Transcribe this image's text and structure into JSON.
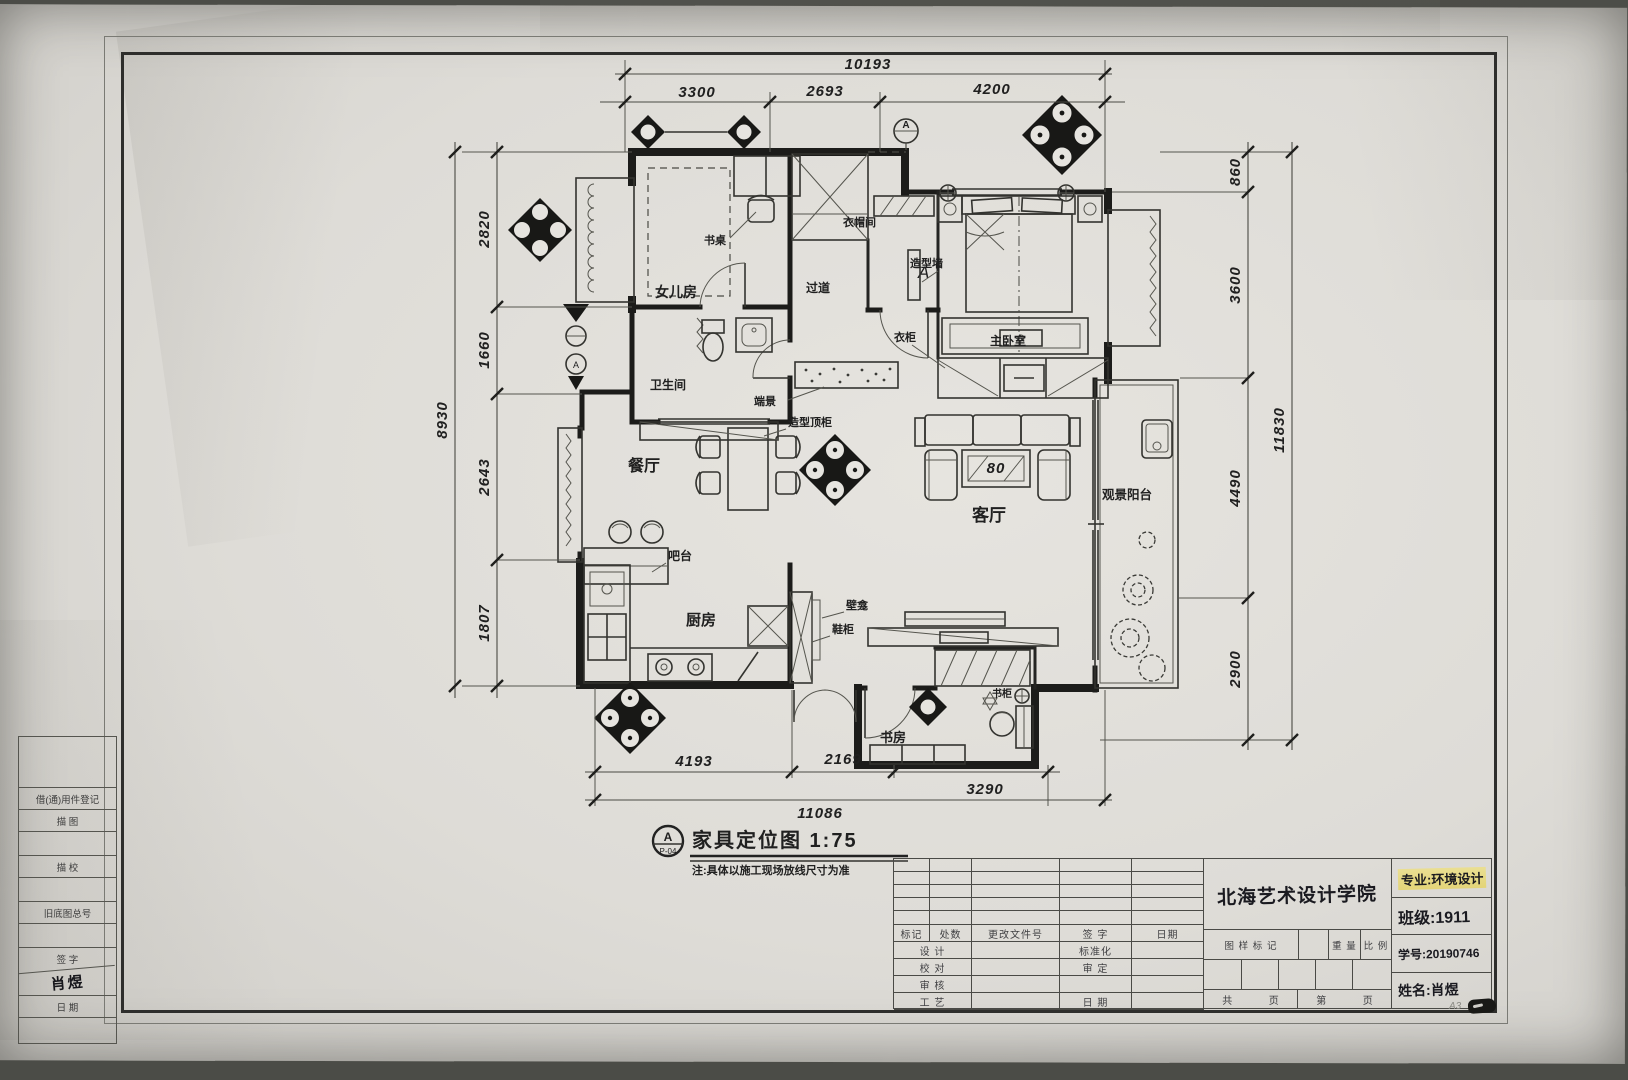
{
  "sheet": {
    "size_label": "A3"
  },
  "left_panel": {
    "rows": [
      "借(通)用件登记",
      "描  图",
      "描  校",
      "旧底图总号",
      "签  字",
      "日  期"
    ],
    "signature": "肖煜"
  },
  "callout": {
    "bubble_letter": "A",
    "bubble_code": "P-04",
    "title": "家具定位图 1:75",
    "note": "注:具体以施工现场放线尺寸为准"
  },
  "plan": {
    "rooms": {
      "girls_room": "女儿房",
      "bathroom": "卫生间",
      "corridor": "过道",
      "cloakroom": "衣帽间",
      "master_bedroom": "主卧室",
      "dining_room": "餐厅",
      "kitchen": "厨房",
      "living_room": "客厅",
      "balcony": "观景阳台",
      "study": "书房"
    },
    "labels": {
      "desk": "书桌",
      "feature_wall": "造型墙",
      "wardrobe": "衣柜",
      "end_table": "端景",
      "shaped_top_cabinet": "造型顶柜",
      "bar": "吧台",
      "wall_niche": "壁龛",
      "shoe_cabinet": "鞋柜",
      "bookcase": "书柜",
      "section_a": "A",
      "table_size": "80"
    },
    "dims": {
      "top": {
        "total": "10193",
        "segments": [
          "3300",
          "2693",
          "4200"
        ]
      },
      "left": {
        "total": "8930",
        "segments": [
          "2820",
          "1660",
          "2643",
          "1807"
        ]
      },
      "right": {
        "total": "11830",
        "segments": [
          "860",
          "3600",
          "4490",
          "2900"
        ]
      },
      "bottom": {
        "total": "11086",
        "segments": [
          "4193",
          "2169",
          "3290"
        ]
      }
    }
  },
  "title_block": {
    "school": "北海艺术设计学院",
    "revision_header": [
      "标记",
      "处数",
      "更改文件号",
      "签  字",
      "日期"
    ],
    "col_a": [
      "设  计",
      "校  对",
      "审  核",
      "工  艺"
    ],
    "col_b": [
      "标准化",
      "审  定",
      "",
      "日  期"
    ],
    "stamp": {
      "mark": "图 样 标 记",
      "weight": "重 量",
      "scale": "比 例",
      "total": "共",
      "page": "页",
      "no": "第",
      "page2": "页"
    },
    "fields": {
      "major": "专业:环境设计",
      "class": "班级:1911",
      "student_id": "学号:20190746",
      "name": "姓名:肖煜"
    }
  }
}
